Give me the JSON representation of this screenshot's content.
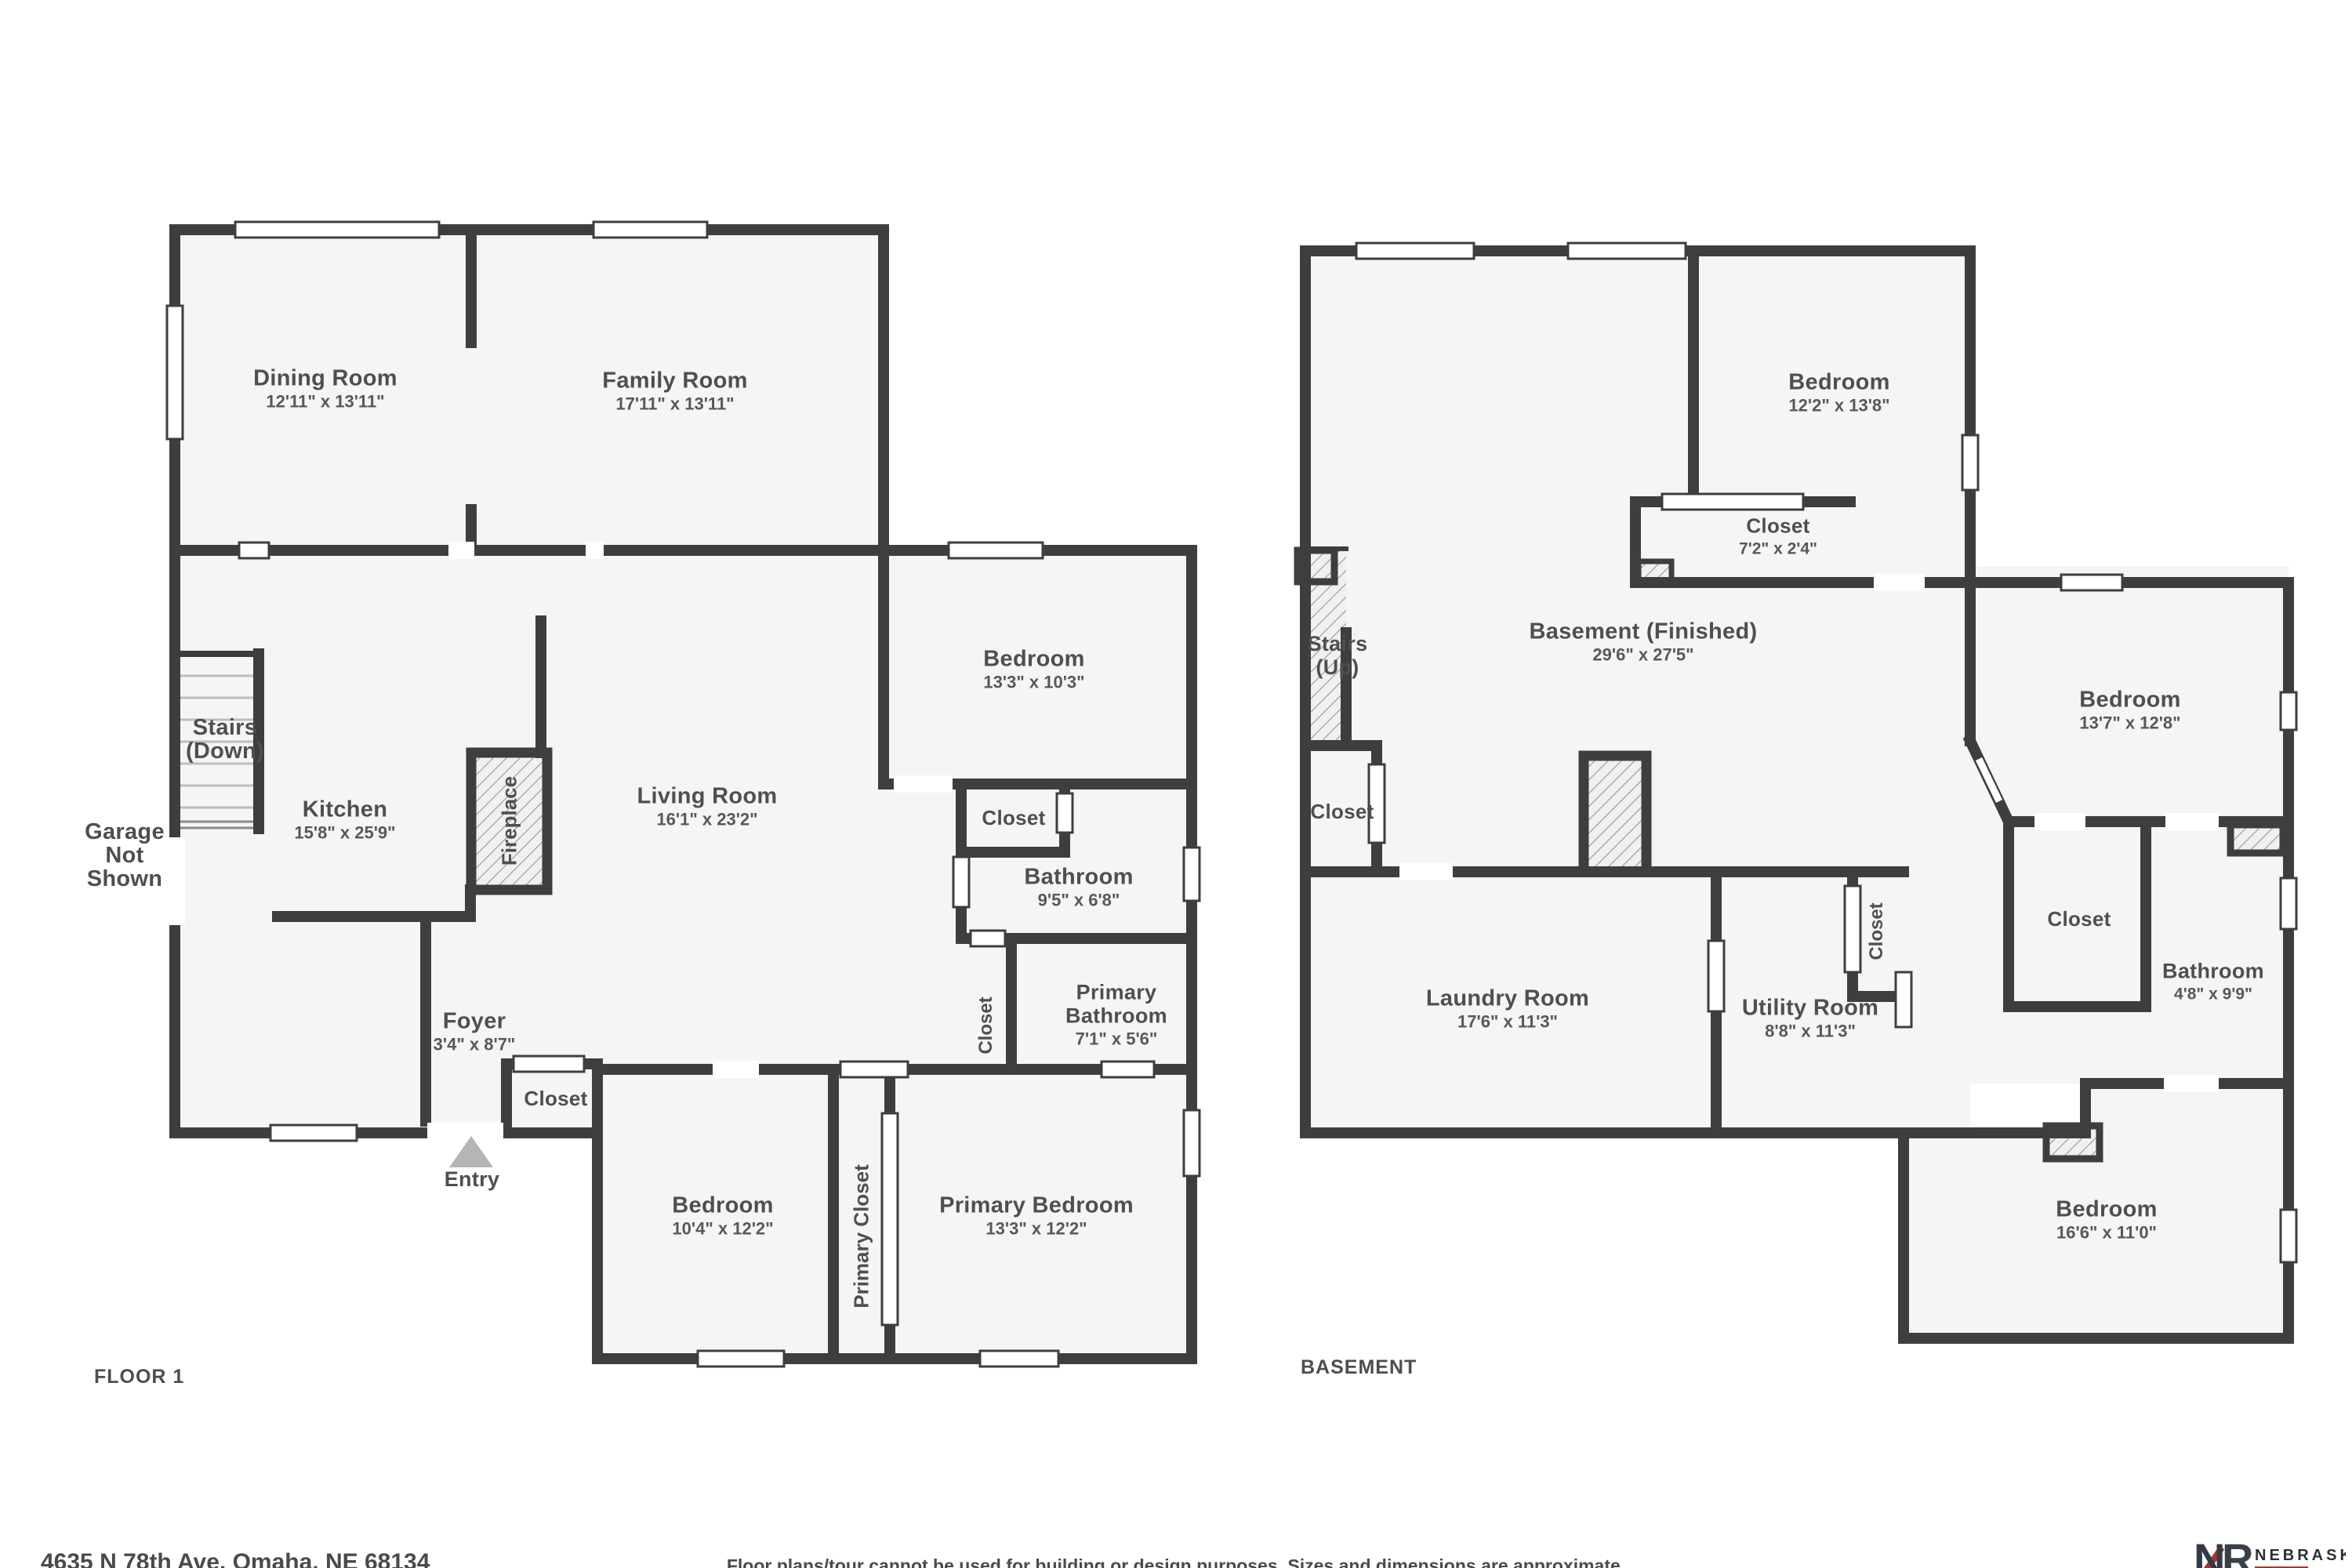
{
  "colors": {
    "wall": "#3e3e3e",
    "floor": "#f5f5f5",
    "label": "#4f4f4f",
    "entry_arrow": "#b5b5b5",
    "logo_red": "#a63632",
    "logo_dark": "#343a42"
  },
  "floor1": {
    "section_label": "FLOOR 1",
    "rooms": {
      "dining": {
        "name": "Dining Room",
        "dims": "12'11\" x 13'11\""
      },
      "family": {
        "name": "Family Room",
        "dims": "17'11\" x 13'11\""
      },
      "bedroom_top": {
        "name": "Bedroom",
        "dims": "13'3\" x 10'3\""
      },
      "living": {
        "name": "Living Room",
        "dims": "16'1\" x 23'2\""
      },
      "kitchen": {
        "name": "Kitchen",
        "dims": "15'8\" x 25'9\""
      },
      "stairs": {
        "l1": "Stairs",
        "l2": "(Down)"
      },
      "garage": {
        "l1": "Garage",
        "l2": "Not",
        "l3": "Shown"
      },
      "fireplace": {
        "name": "Fireplace"
      },
      "foyer": {
        "name": "Foyer",
        "dims": "3'4\" x 8'7\""
      },
      "closet_foyer": {
        "name": "Closet"
      },
      "entry": {
        "name": "Entry"
      },
      "bedroom_bottom": {
        "name": "Bedroom",
        "dims": "10'4\" x 12'2\""
      },
      "primary_closet": {
        "name": "Primary Closet"
      },
      "primary_bedroom": {
        "name": "Primary Bedroom",
        "dims": "13'3\" x 12'2\""
      },
      "closet_hall": {
        "name": "Closet"
      },
      "bathroom": {
        "name": "Bathroom",
        "dims": "9'5\" x 6'8\""
      },
      "closet_small": {
        "name": "Closet"
      },
      "primary_bathroom": {
        "l1": "Primary",
        "l2": "Bathroom",
        "dims": "7'1\" x 5'6\""
      }
    }
  },
  "basement": {
    "section_label": "BASEMENT",
    "rooms": {
      "bedroom_top": {
        "name": "Bedroom",
        "dims": "12'2\" x 13'8\""
      },
      "closet_top": {
        "name": "Closet",
        "dims": "7'2\" x 2'4\""
      },
      "main": {
        "name": "Basement (Finished)",
        "dims": "29'6\" x 27'5\""
      },
      "stairs": {
        "l1": "Stairs",
        "l2": "(Up)"
      },
      "closet_stairs": {
        "name": "Closet"
      },
      "laundry": {
        "name": "Laundry Room",
        "dims": "17'6\" x 11'3\""
      },
      "utility": {
        "name": "Utility Room",
        "dims": "8'8\" x 11'3\""
      },
      "closet_utility": {
        "name": "Closet"
      },
      "bedroom_right": {
        "name": "Bedroom",
        "dims": "13'7\" x 12'8\""
      },
      "closet_right": {
        "name": "Closet"
      },
      "bathroom": {
        "name": "Bathroom",
        "dims": "4'8\" x 9'9\""
      },
      "bedroom_bottom": {
        "name": "Bedroom",
        "dims": "16'6\" x 11'0\""
      }
    }
  },
  "footer": {
    "address": "4635 N 78th Ave, Omaha, NE 68134",
    "disclaimer": "Floor plans/tour cannot be used for building or design purposes. Sizes and dimensions are approximate.",
    "logo": {
      "monogram_n": "N",
      "monogram_r": "R",
      "name": "NEBRASKA",
      "subname": "REALTY"
    }
  }
}
